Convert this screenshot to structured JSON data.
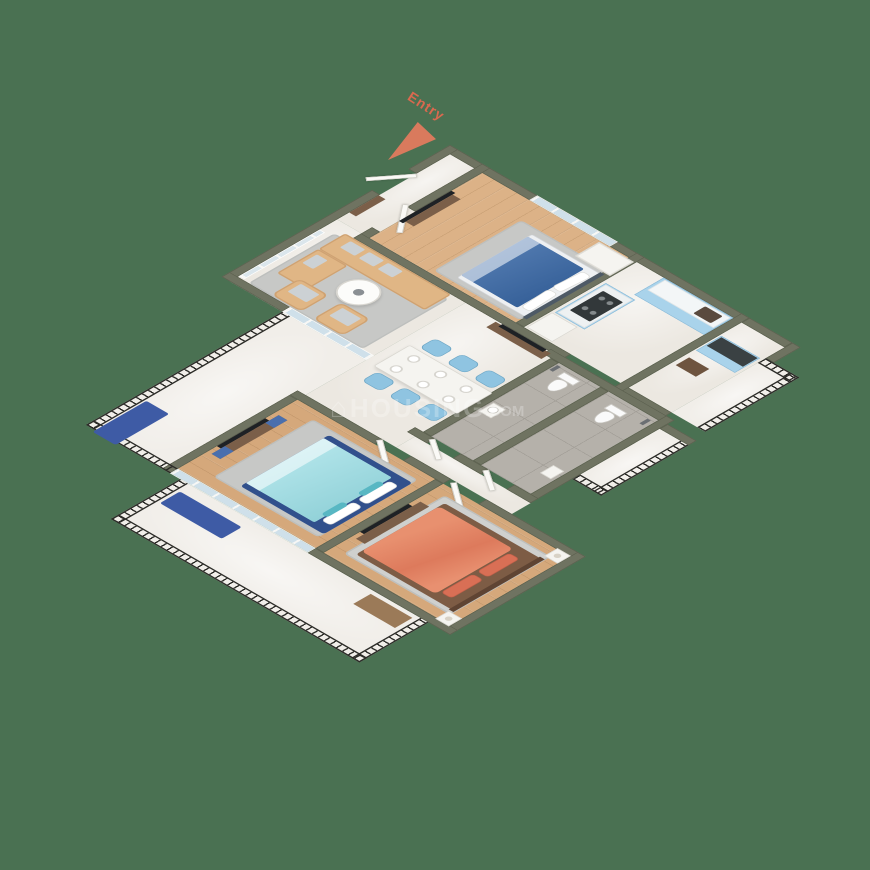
{
  "scene": {
    "type": "3d-isometric-floor-plan",
    "description": "Rendered 3D top-down isometric floor plan of an apartment with two balconies, living-dining area, kitchen, two bathrooms and three bedrooms on a plain green background"
  },
  "labels": {
    "entry": "Entry"
  },
  "watermark": {
    "glyph": "⌂",
    "text_main": "HOUSING",
    "text_suffix": ".COM"
  },
  "palette": {
    "background": "#4a7152",
    "wall": "#6f7361",
    "wood_floor": "#dcb287",
    "marble_floor": "#ece8e1",
    "bathroom_tile": "#b5b1aa",
    "balcony_floor": "#f1eee9",
    "railing": "#2b2b27",
    "kitchen_cabinet_blue": "#a9d3eb",
    "counter_top_dark": "#3a4143",
    "bed_blue": "#3b69a6",
    "bed_teal": "#9adde4",
    "bed_teal_frame": "#31508c",
    "bed_coral": "#e28266",
    "sofa_beige": "#e0b685",
    "dining_chair_blue": "#8fc4e1",
    "rug_gray": "#c7c8c6",
    "entry_accent": "#de7a5f"
  },
  "rooms": [
    {
      "name": "entry-foyer",
      "furniture": [
        "entry-door",
        "shoe-shelf"
      ]
    },
    {
      "name": "bedroom-1",
      "furniture": [
        "double-bed-blue",
        "wardrobe",
        "tv-panel",
        "tv-console",
        "window",
        "rug"
      ]
    },
    {
      "name": "kitchen",
      "furniture": [
        "counter-with-sink",
        "hob-island",
        "refrigerator"
      ]
    },
    {
      "name": "utility-store",
      "furniture": [
        "cabinet-dark-top",
        "shelf"
      ]
    },
    {
      "name": "utility-balcony",
      "furniture": [
        "railing"
      ]
    },
    {
      "name": "living-room",
      "furniture": [
        "sofa",
        "chaise",
        "armchair",
        "armchair",
        "coffee-table",
        "rug",
        "glass-partition",
        "media-console"
      ]
    },
    {
      "name": "dining-area",
      "furniture": [
        "dining-table",
        "six-chairs",
        "plates"
      ]
    },
    {
      "name": "bathroom-1",
      "furniture": [
        "toilet",
        "sink",
        "shower"
      ]
    },
    {
      "name": "bathroom-2",
      "furniture": [
        "toilet",
        "sink",
        "shower"
      ]
    },
    {
      "name": "side-balcony",
      "furniture": [
        "railing"
      ]
    },
    {
      "name": "left-balcony",
      "furniture": [
        "railing",
        "bench-navy"
      ]
    },
    {
      "name": "bedroom-2",
      "furniture": [
        "double-bed-teal",
        "tv-panel",
        "tv-console",
        "sliding-glass-door",
        "rug"
      ]
    },
    {
      "name": "bedroom-3",
      "furniture": [
        "double-bed-coral",
        "nightstand-with-lamp",
        "nightstand-with-lamp",
        "tv-panel",
        "tv-console",
        "rug"
      ]
    },
    {
      "name": "bottom-balcony",
      "furniture": [
        "railing",
        "bench-navy",
        "mat"
      ]
    }
  ]
}
